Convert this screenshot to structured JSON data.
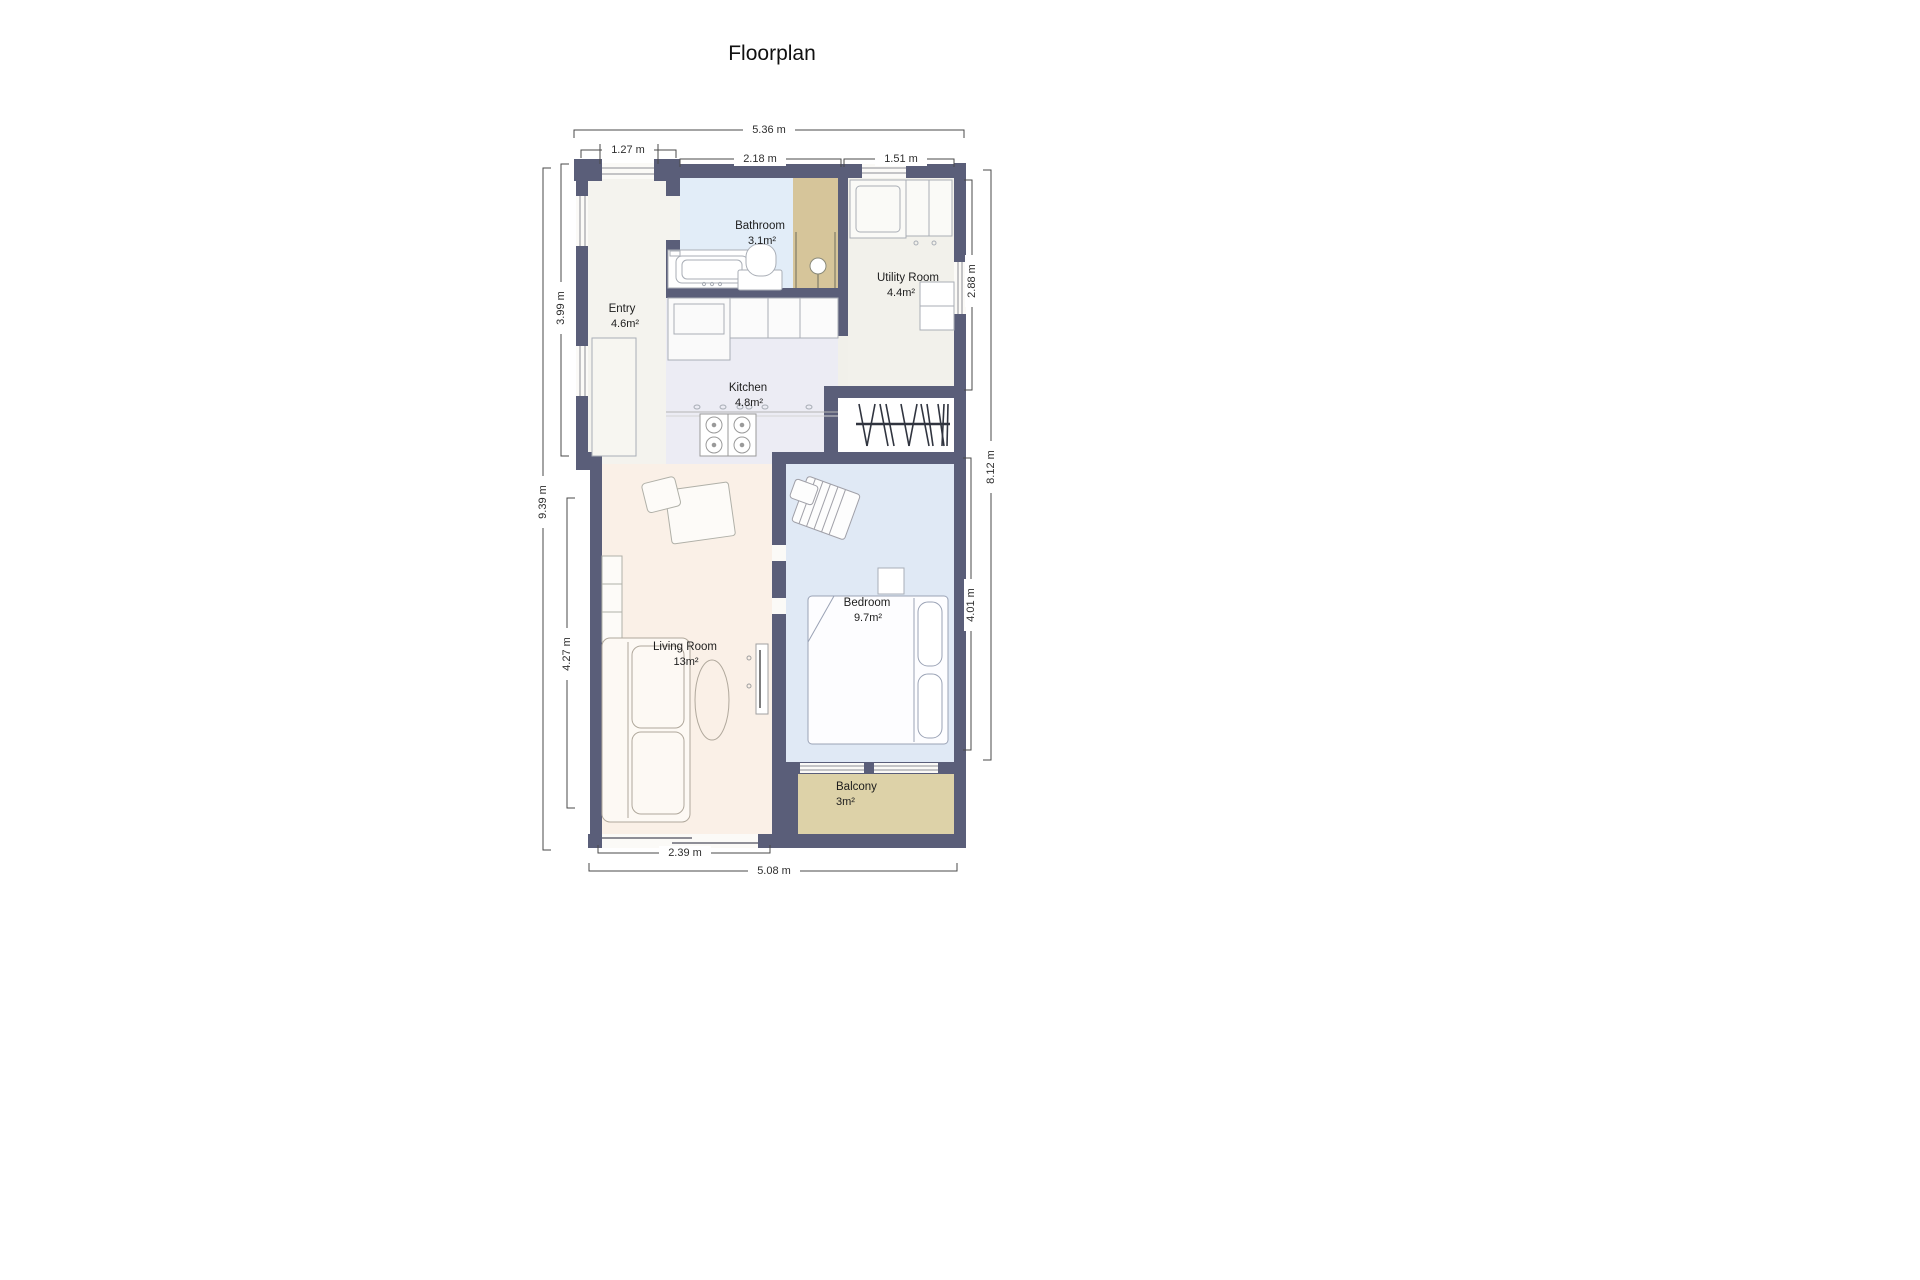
{
  "title": "Floorplan",
  "rooms": {
    "entry": {
      "name": "Entry",
      "area": "4.6m²"
    },
    "bathroom": {
      "name": "Bathroom",
      "area": "3.1m²"
    },
    "utility": {
      "name": "Utility Room",
      "area": "4.4m²"
    },
    "kitchen": {
      "name": "Kitchen",
      "area": "4.8m²"
    },
    "living": {
      "name": "Living Room",
      "area": "13m²"
    },
    "bedroom": {
      "name": "Bedroom",
      "area": "9.7m²"
    },
    "balcony": {
      "name": "Balcony",
      "area": "3m²"
    }
  },
  "dimensions": {
    "top_total": "5.36 m",
    "top_entry_window": "1.27 m",
    "top_bathroom": "2.18 m",
    "top_utility": "1.51 m",
    "left_total": "9.39 m",
    "left_entry": "3.99 m",
    "left_living": "4.27 m",
    "right_utility": "2.88 m",
    "right_total": "8.12 m",
    "right_bedroom": "4.01 m",
    "bottom_living": "2.39 m",
    "bottom_total": "5.08 m"
  },
  "colors": {
    "wall": "#5a5e79",
    "entry_floor": "#f4f3ee",
    "bathroom_floor": "#e2edf8",
    "shower_floor": "#d6c59a",
    "utility_floor": "#f2f1eb",
    "kitchen_floor": "#ececf4",
    "living_floor": "#faf0e7",
    "bedroom_floor": "#e0e9f5",
    "balcony_floor": "#ddd2a8",
    "closet_floor": "#ffffff"
  }
}
